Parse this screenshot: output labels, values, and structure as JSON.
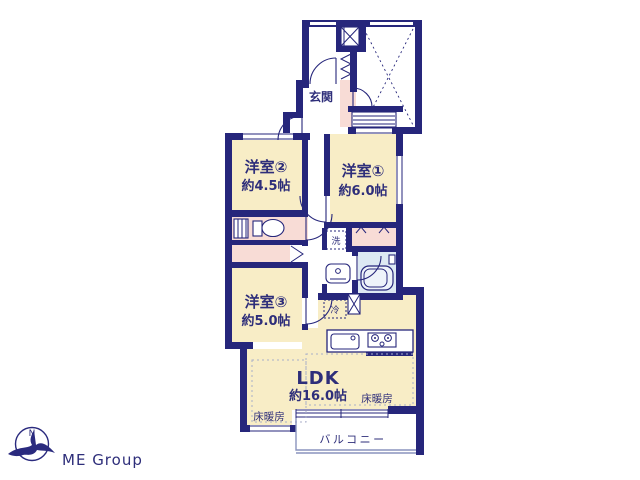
{
  "plan": {
    "labels": {
      "genkan": "玄関",
      "room1_name": "洋室①",
      "room1_size": "約6.0帖",
      "room2_name": "洋室②",
      "room2_size": "約4.5帖",
      "room3_name": "洋室③",
      "room3_size": "約5.0帖",
      "ldk_name": "LDK",
      "ldk_size": "約16.0帖",
      "washer": "洗",
      "fridge": "冷",
      "floor_heating": "床暖房",
      "balcony": "バルコニー"
    },
    "colors": {
      "wall_navy": "#26267b",
      "room_yellow": "#f8edc6",
      "closet_pink": "#f8dcd6",
      "bath_blue": "#dde9f3",
      "label_navy": "#2e2e7a",
      "balcony_gray": "#8a93bd",
      "logo_text_gray": "#c9c9c9"
    }
  },
  "logo": {
    "company": "ME Group",
    "compass_letter": "N"
  }
}
